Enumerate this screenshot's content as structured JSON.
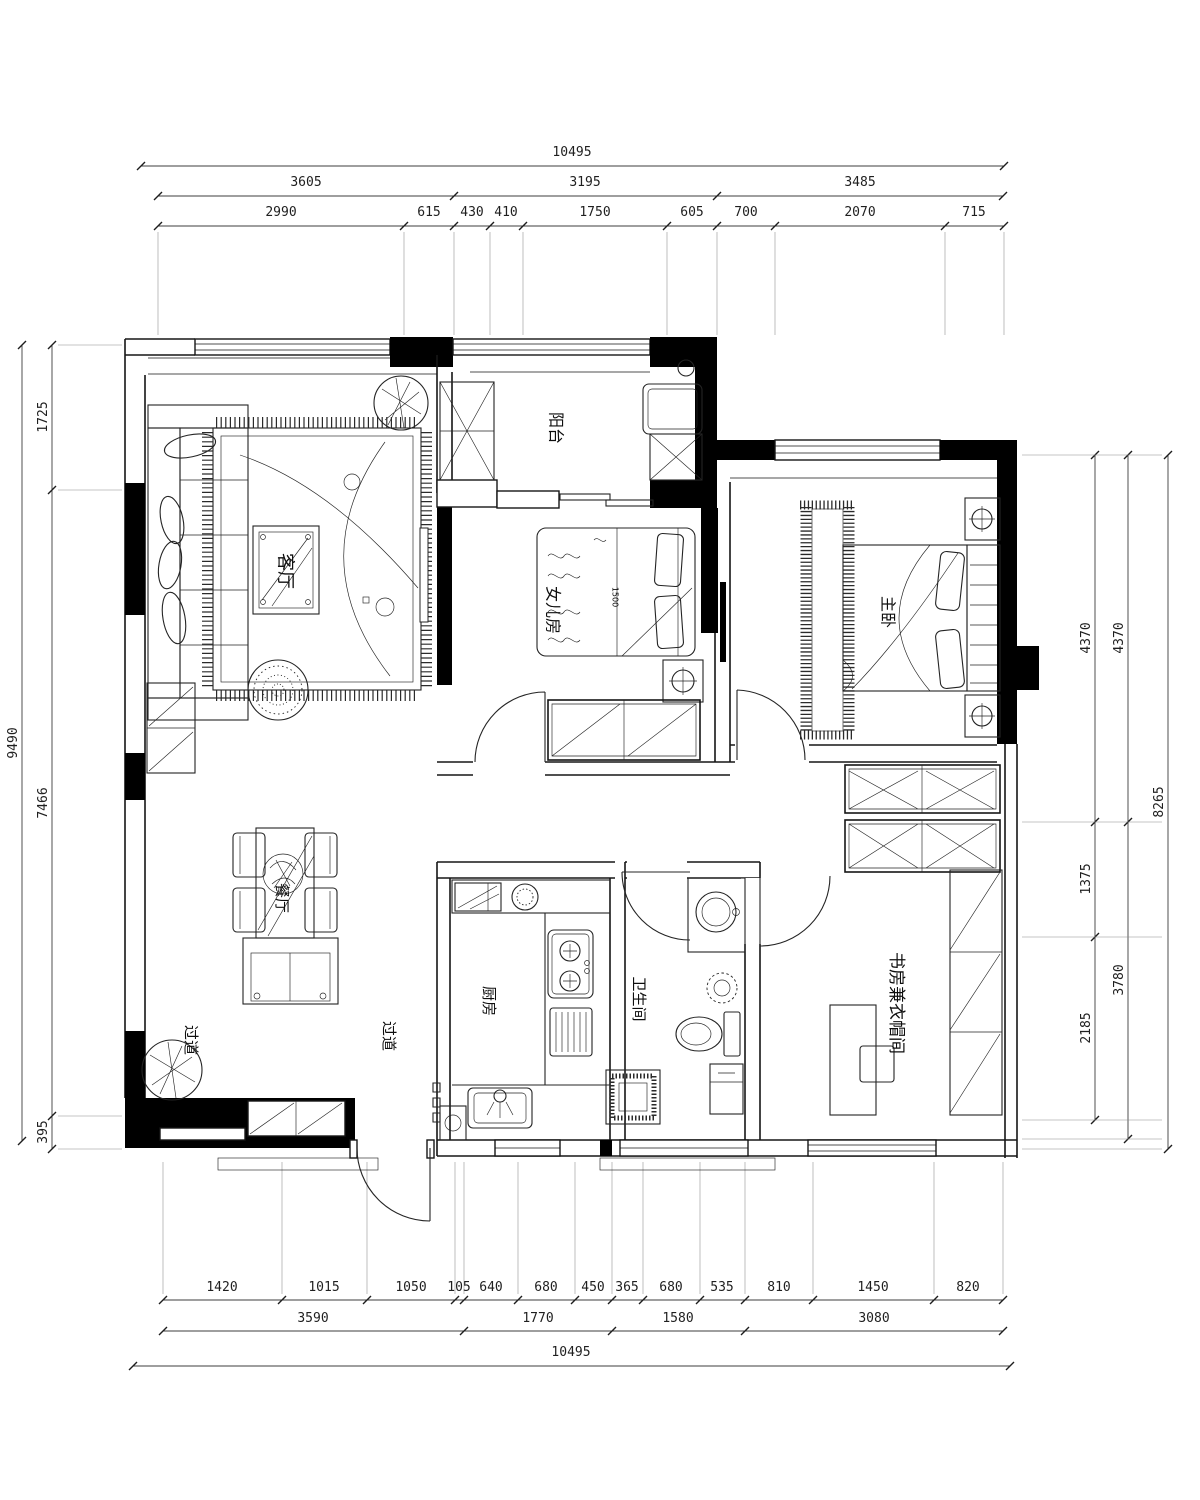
{
  "meta": {
    "drawing_type": "apartment floor plan"
  },
  "dims": {
    "top": {
      "row1": [
        "10495"
      ],
      "row2": [
        "3605",
        "3195",
        "3485"
      ],
      "row3": [
        "2990",
        "615",
        "430",
        "410",
        "1750",
        "605",
        "700",
        "2070",
        "715"
      ]
    },
    "bottom": {
      "row1": [
        "1420",
        "1015",
        "1050",
        "105",
        "640",
        "680",
        "450",
        "365",
        "680",
        "535",
        "810",
        "1450",
        "820"
      ],
      "row2": [
        "3590",
        "1770",
        "1580",
        "3080"
      ],
      "row3": [
        "10495"
      ]
    },
    "left": {
      "outer": [
        "9490"
      ],
      "inner": [
        "1725",
        "7466",
        "395"
      ]
    },
    "right": {
      "inner": [
        "4370",
        "1375",
        "2185"
      ],
      "mid": [
        "4370",
        "3780"
      ],
      "outer": [
        "8265"
      ]
    }
  },
  "rooms": {
    "living": "客厅",
    "balcony": "阳台",
    "daughter_room": "女儿房",
    "master_bedroom": "主卧",
    "dining": "餐厅",
    "kitchen": "厨房",
    "bathroom": "卫生间",
    "corridor_a": "过道",
    "corridor_b": "过道",
    "study": "书房兼衣帽间"
  },
  "annotations": {
    "bed_width": "1500"
  },
  "colors": {
    "background": "#ffffff",
    "line": "#1a1a1a",
    "wall_fill": "#000000",
    "dim_text": "#1f1f1f"
  }
}
